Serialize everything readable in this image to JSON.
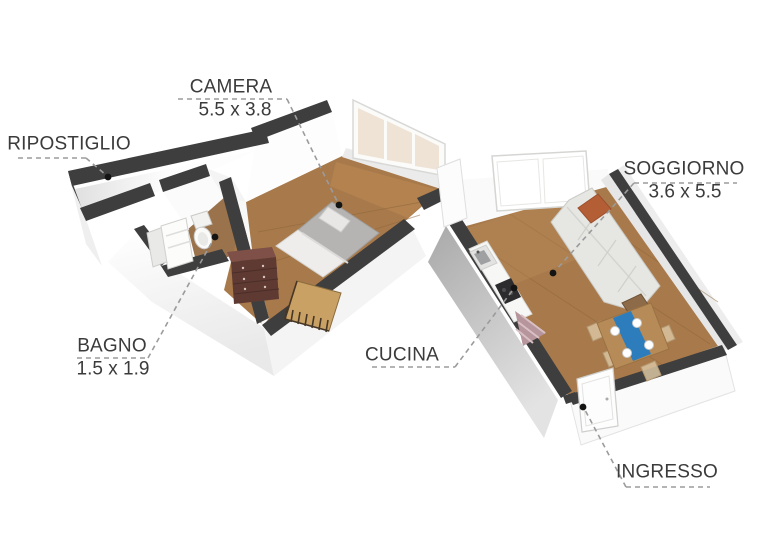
{
  "floorplan": {
    "rooms": [
      {
        "id": "ripostiglio",
        "name": "RIPOSTIGLIO",
        "dims": ""
      },
      {
        "id": "camera",
        "name": "CAMERA",
        "dims": "5.5 x 3.8"
      },
      {
        "id": "soggiorno",
        "name": "SOGGIORNO",
        "dims": "3.6 x 5.5"
      },
      {
        "id": "bagno",
        "name": "BAGNO",
        "dims": "1.5 x 1.9"
      },
      {
        "id": "cucina",
        "name": "CUCINA",
        "dims": ""
      },
      {
        "id": "ingresso",
        "name": "INGRESSO",
        "dims": ""
      }
    ],
    "colors": {
      "wall_top": "#3e3e3e",
      "wood_floor": "#a87a4b",
      "bath_floor": "#9a734c",
      "label_text": "#3b3b3b",
      "leader_line": "#9b9b9b",
      "leader_dot": "#141414",
      "sofa_pillow": "#b45e36",
      "table_runner": "#2d7dbd",
      "dresser": "#5f3a33",
      "crib": "#c9a164"
    }
  }
}
